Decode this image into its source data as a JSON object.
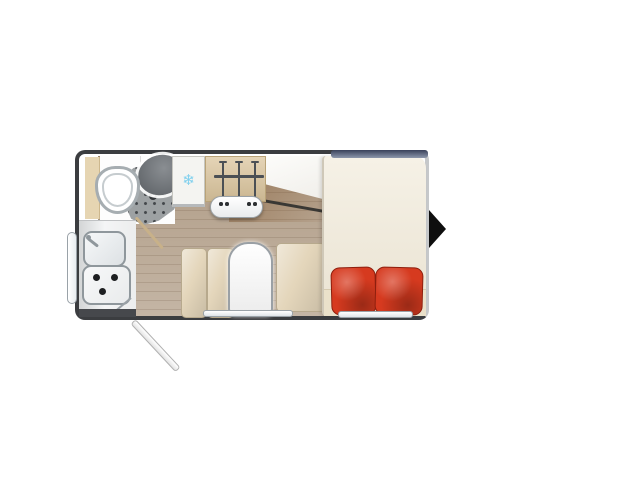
{
  "meta": {
    "description": "caravan floor plan, top-down view, no text labels"
  },
  "floorplan": {
    "areas": [
      {
        "name": "bathroom",
        "fixtures": [
          "toilet",
          "shower-tray",
          "washbasin"
        ],
        "door": "diagonal-open"
      },
      {
        "name": "fridge",
        "icon": "snowflake-icon"
      },
      {
        "name": "wardrobe",
        "hanger_count": 3
      },
      {
        "name": "heater",
        "knob_count": 4
      },
      {
        "name": "kitchen",
        "fixtures": [
          "sink-with-faucet",
          "hob-3-burner"
        ],
        "burner_count": 3
      },
      {
        "name": "dinette",
        "fixtures": [
          "bench-left-2-cushions",
          "table",
          "bench-right"
        ]
      },
      {
        "name": "bed",
        "pillow_count": 2
      }
    ],
    "entry_arrow_direction": "right",
    "open_door_position": "bottom-left",
    "windows": [
      "left-side",
      "bottom-dinette",
      "bottom-bed",
      "top-bed"
    ],
    "glyphs": {
      "snowflake": "❄"
    },
    "colors": {
      "wall_dark": "#3b3d40",
      "wood_floor": "#b7a591",
      "cabinet_beige": "#e6d5b2",
      "bath_white": "#fdfdfd",
      "shower_gray": "#9da1a3",
      "basin_gray": "#70757a",
      "fridge_white": "#f4f4f1",
      "snowflake_blue": "#7fd0ee",
      "wardrobe_tan": "#dcc69e",
      "bench_beige": "#e4d6bb",
      "table_white": "#fbfbfb",
      "bed_cream": "#f1ead9",
      "bed_foot": "#eae1ca",
      "pillow_red": "#d63a1f",
      "arrow_black": "#0e0e0e"
    }
  }
}
